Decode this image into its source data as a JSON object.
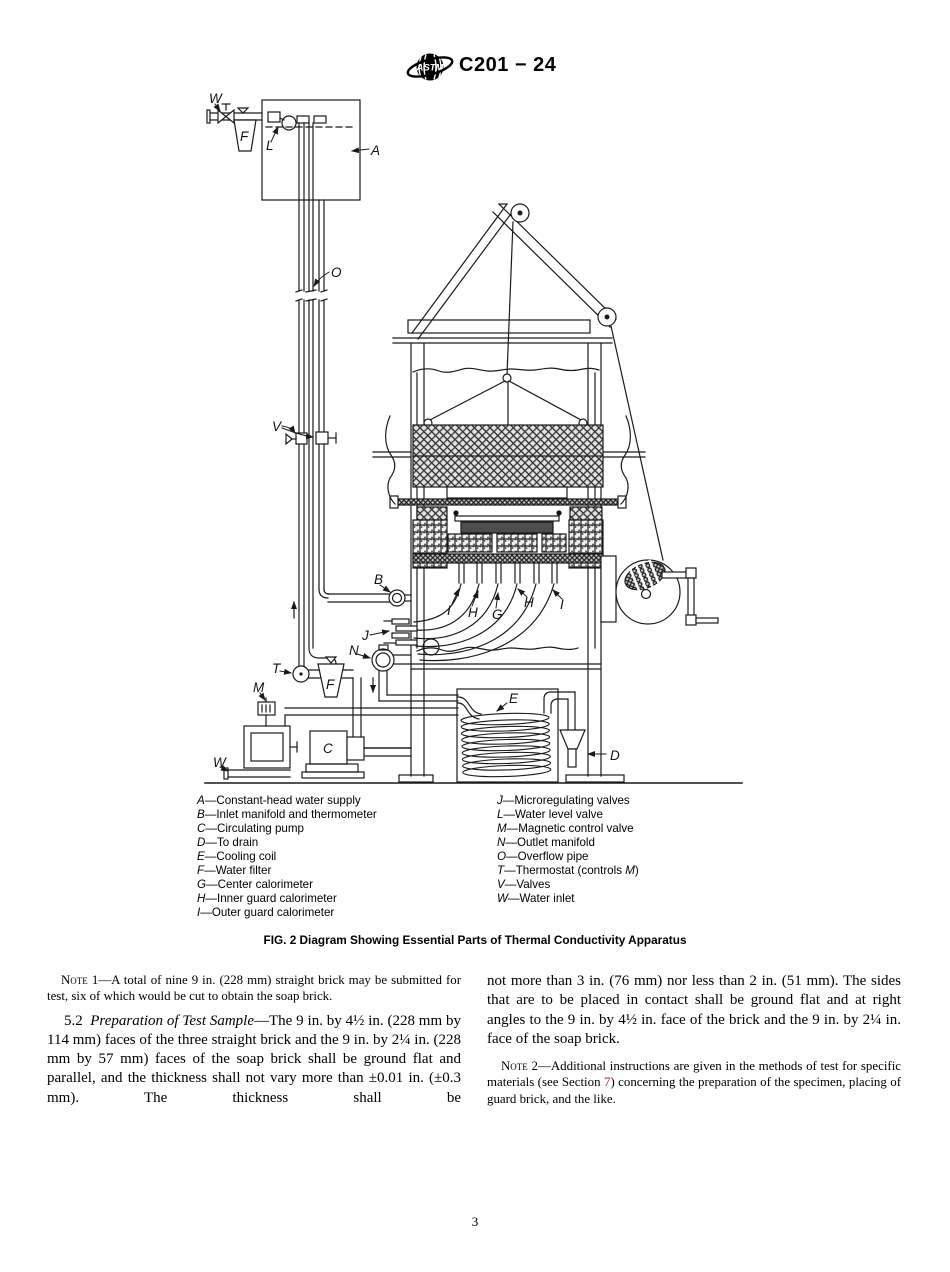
{
  "header": {
    "logo_text": "ASTM",
    "doc_number": "C201 − 24"
  },
  "figure": {
    "caption": "FIG. 2 Diagram Showing Essential Parts of Thermal Conductivity Apparatus",
    "labels": {
      "A": "A",
      "B": "B",
      "C": "C",
      "D": "D",
      "E": "E",
      "F": "F",
      "G": "G",
      "H": "H",
      "I": "I",
      "J": "J",
      "L": "L",
      "M": "M",
      "N": "N",
      "O": "O",
      "T": "T",
      "V": "V",
      "W": "W"
    },
    "legend_left": [
      {
        "key": "A",
        "desc": "Constant-head water supply"
      },
      {
        "key": "B",
        "desc": "Inlet manifold and thermometer"
      },
      {
        "key": "C",
        "desc": "Circulating pump"
      },
      {
        "key": "D",
        "desc": "To drain"
      },
      {
        "key": "E",
        "desc": "Cooling coil"
      },
      {
        "key": "F",
        "desc": "Water filter"
      },
      {
        "key": "G",
        "desc": "Center calorimeter"
      },
      {
        "key": "H",
        "desc": "Inner guard calorimeter"
      },
      {
        "key": "I",
        "desc": "Outer guard calorimeter"
      }
    ],
    "legend_right": [
      {
        "key": "J",
        "desc": "Microregulating valves"
      },
      {
        "key": "L",
        "desc": "Water level valve"
      },
      {
        "key": "M",
        "desc": "Magnetic control valve"
      },
      {
        "key": "N",
        "desc": "Outlet manifold"
      },
      {
        "key": "O",
        "desc": "Overflow pipe"
      },
      {
        "key": "T",
        "desc_pre": "Thermostat (controls ",
        "desc_it": "M",
        "desc_post": ")"
      },
      {
        "key": "V",
        "desc": "Valves"
      },
      {
        "key": "W",
        "desc": "Water inlet"
      }
    ]
  },
  "body": {
    "note1": {
      "label": "Note 1",
      "text": "—A total of nine 9 in. (228 mm) straight brick may be submitted for test, six of which would be cut to obtain the soap brick."
    },
    "para52": {
      "number": "5.2",
      "title": "Preparation of Test Sample",
      "text": "—The 9 in. by 4½ in. (228 mm by 114 mm) faces of the three straight brick and the 9 in. by 2¼ in. (228 mm by 57 mm) faces of the soap brick shall be ground flat and parallel, and the thickness shall not vary more than ±0.01 in. (±0.3 mm). The thickness shall be"
    },
    "para52_cont": "not more than 3 in. (76 mm) nor less than 2 in. (51 mm). The sides that are to be placed in contact shall be ground flat and at right angles to the 9 in. by 4½ in. face of the brick and the 9 in. by 2¼ in. face of the soap brick.",
    "note2": {
      "label": "Note 2",
      "pre": "—Additional instructions are given in the methods of test for specific materials (see Section ",
      "link": "7",
      "post": ") concerning the preparation of the specimen, placing of guard brick, and the like."
    }
  },
  "footer": {
    "page_number": "3"
  },
  "colors": {
    "ink": "#1a1a1a",
    "xref_red": "#c02020"
  }
}
